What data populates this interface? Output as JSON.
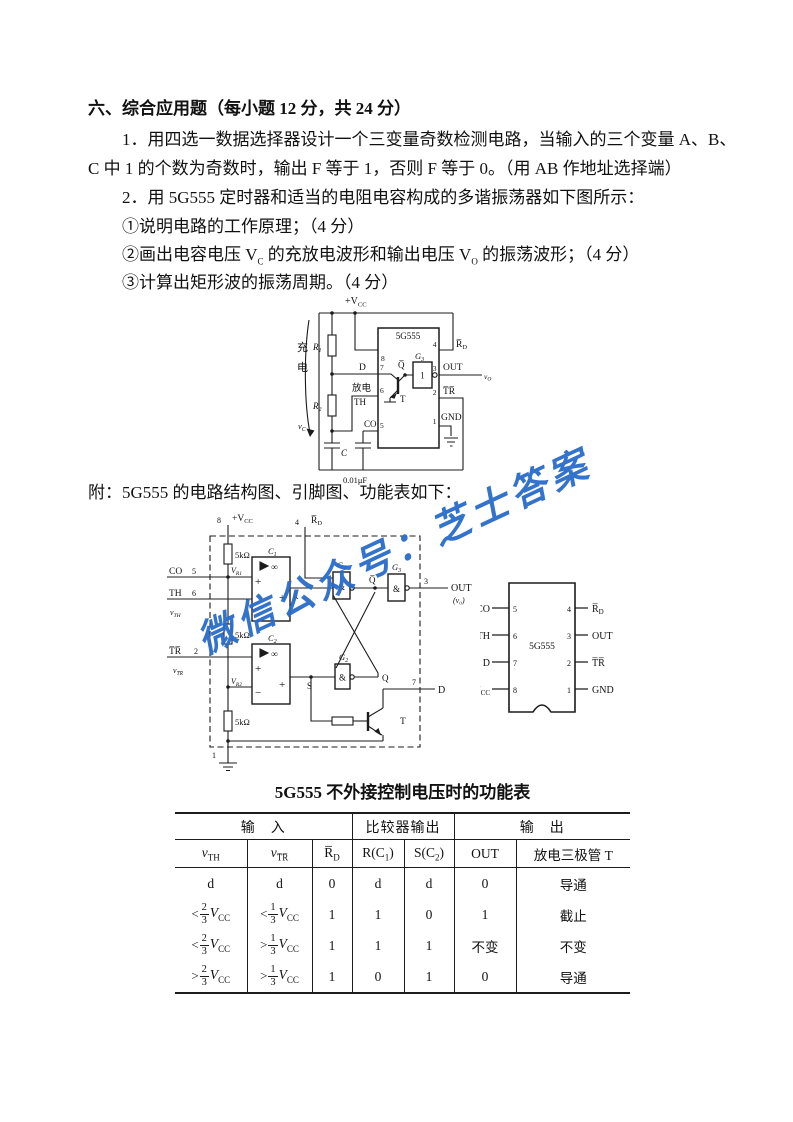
{
  "doc": {
    "heading": "六、综合应用题（每小题 12 分，共 24 分）",
    "q1_l1": "1．用四选一数据选择器设计一个三变量奇数检测电路，当输入的三个变量 A、B、",
    "q1_l2": "C 中 1 的个数为奇数时，输出 F 等于 1，否则 F 等于 0。（用 AB 作地址选择端）",
    "q2": "2．用 5G555 定时器和适当的电阻电容构成的多谐振荡器如下图所示：",
    "s1": "①说明电路的工作原理；（4 分）",
    "s2a": "②画出电容电压 V",
    "s2b": "C",
    "s2c": " 的充放电波形和输出电压 V",
    "s2d": "O",
    "s2e": " 的振荡波形；（4 分）",
    "s3": "③计算出矩形波的振荡周期。（4 分）",
    "appendix": "附：5G555 的电路结构图、引脚图、功能表如下：",
    "watermark": "微信公众号：芝士答案",
    "watermark_color": "#2a6cc9"
  },
  "c1": {
    "vcc_m": "+V",
    "vcc_s": "CC",
    "chg1": "充",
    "chg2": "电",
    "r1m": "R",
    "r1s": "1",
    "r2m": "R",
    "r2s": "2",
    "d": "D",
    "fd": "放电",
    "th": "TH",
    "co": "CO",
    "vcm": "v",
    "vcs": "C",
    "cap": "C",
    "cap2": "0.01μF",
    "chip": "5G555",
    "g3m": "G",
    "g3s": "3",
    "g3in": "1",
    "qbar": "Q̅",
    "t": "T",
    "rdm": "R̅",
    "rds": "D",
    "out": "OUT",
    "vom": "v",
    "vos": "O",
    "tr": "T̅R̅",
    "gnd": "GND",
    "p8": "8",
    "p7": "7",
    "p6": "6",
    "p5": "5",
    "p4": "4",
    "p3": "3",
    "p2": "2",
    "p1": "1"
  },
  "sd": {
    "p8": "8",
    "vccm": "+V",
    "vccs": "CC",
    "r5k": "5kΩ",
    "vr1m": "V",
    "vr1s": "R1",
    "vr2m": "V",
    "vr2s": "R2",
    "co": "CO",
    "co_n": "5",
    "th": "TH",
    "th_n": "6",
    "vthm": "v",
    "vths": "TH",
    "tr": "T̅R̅",
    "tr_n": "2",
    "vtrm": "v",
    "vtrs": "T̅R̅",
    "c1m": "C",
    "c1s": "1",
    "c2m": "C",
    "c2s": "2",
    "inf": "∞",
    "plus": "+",
    "minus": "−",
    "rdm": "R̅",
    "rds": "D",
    "p4": "4",
    "g1m": "G",
    "g1s": "1",
    "g2m": "G",
    "g2s": "2",
    "g3m": "G",
    "g3s": "3",
    "amp": "&",
    "qbar": "Q̅",
    "q": "Q",
    "s": "S",
    "r": "R",
    "p3": "3",
    "out": "OUT",
    "vo": "(v₀)",
    "p7": "7",
    "d": "D",
    "t": "T",
    "p1": "1"
  },
  "pd": {
    "chip": "5G555",
    "co": "CO",
    "th": "TH",
    "d": "D",
    "vccm": "V",
    "vccs": "CC",
    "rdm": "R̅",
    "rds": "D",
    "out": "OUT",
    "tr": "T̅R̅",
    "gnd": "GND",
    "l5": "5",
    "l6": "6",
    "l7": "7",
    "l8": "8",
    "r4": "4",
    "r3": "3",
    "r2": "2",
    "r1": "1"
  },
  "table": {
    "title": "5G555 不外接控制电压时的功能表",
    "groups": [
      {
        "label": "输　入",
        "span": 3
      },
      {
        "label": "比较器输出",
        "span": 2
      },
      {
        "label": "输　出",
        "span": 2
      }
    ],
    "headers": [
      [
        {
          "t": "v",
          "i": true
        },
        {
          "t": "TH",
          "sub": true
        }
      ],
      [
        {
          "t": "v",
          "i": true
        },
        {
          "t": "T̅R̅",
          "sub": true
        }
      ],
      [
        {
          "t": "R̅"
        },
        {
          "t": "D",
          "sub": true
        }
      ],
      [
        {
          "t": "R(C"
        },
        {
          "t": "1",
          "sub": true
        },
        {
          "t": ")"
        }
      ],
      [
        {
          "t": "S(C"
        },
        {
          "t": "2",
          "sub": true
        },
        {
          "t": ")"
        }
      ],
      [
        {
          "t": "OUT"
        }
      ],
      [
        {
          "t": "放电三极管 T"
        }
      ]
    ],
    "vcc": {
      "m": "V",
      "s": "CC"
    },
    "rows": [
      [
        "d",
        "d",
        "0",
        "d",
        "d",
        "0",
        "导通"
      ],
      [
        {
          "cmp": "<",
          "num": "2",
          "den": "3"
        },
        {
          "cmp": "<",
          "num": "1",
          "den": "3"
        },
        "1",
        "1",
        "0",
        "1",
        "截止"
      ],
      [
        {
          "cmp": "<",
          "num": "2",
          "den": "3"
        },
        {
          "cmp": ">",
          "num": "1",
          "den": "3"
        },
        "1",
        "1",
        "1",
        "不变",
        "不变"
      ],
      [
        {
          "cmp": ">",
          "num": "2",
          "den": "3"
        },
        {
          "cmp": ">",
          "num": "1",
          "den": "3"
        },
        "1",
        "0",
        "1",
        "0",
        "导通"
      ]
    ]
  }
}
